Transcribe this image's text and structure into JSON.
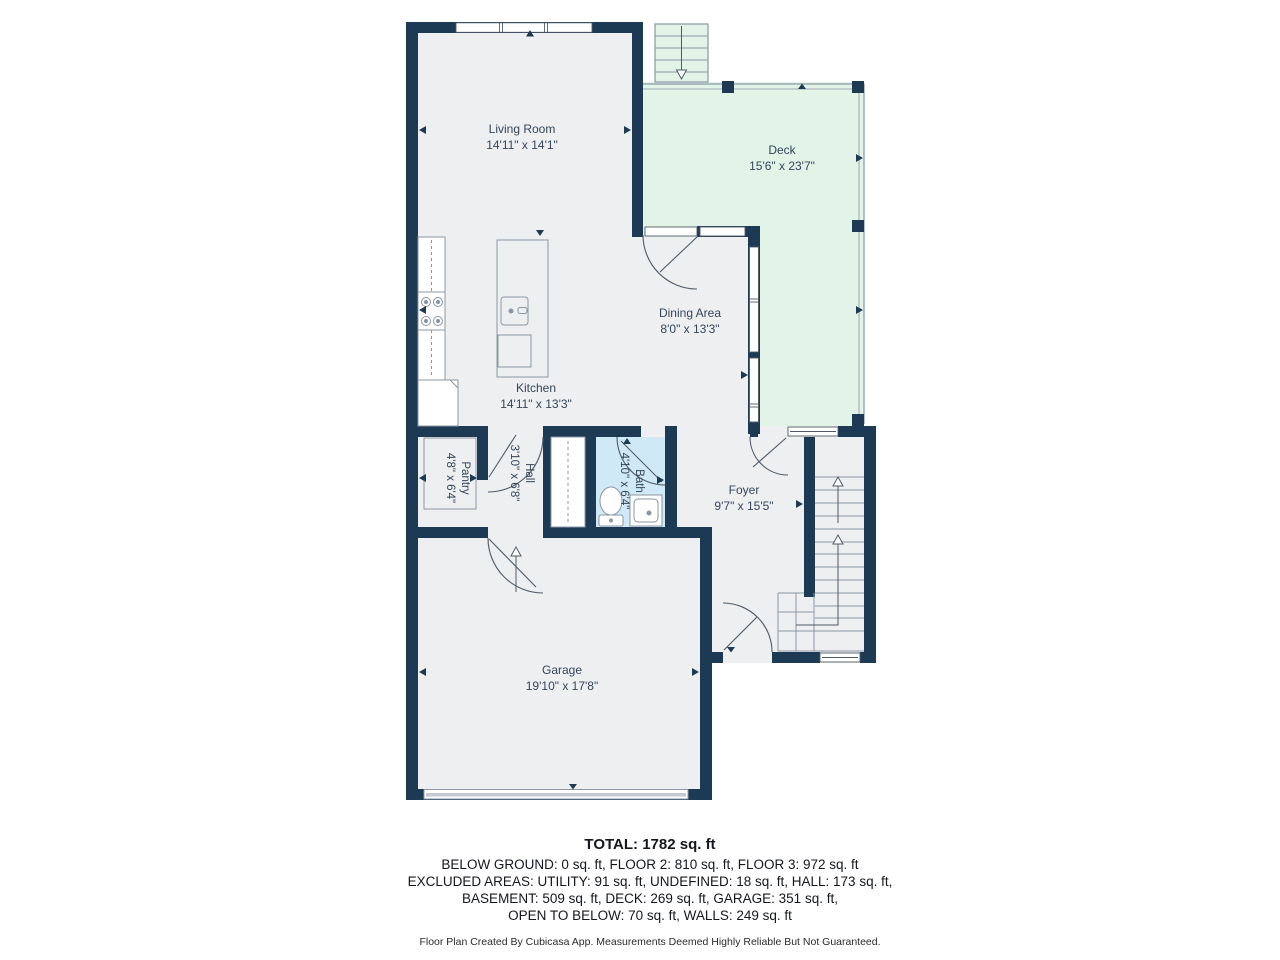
{
  "plan": {
    "rooms": [
      {
        "id": "living_room",
        "name": "Living Room",
        "dimensions": "14'11\" x 14'1\""
      },
      {
        "id": "deck",
        "name": "Deck",
        "dimensions": "15'6\" x 23'7\""
      },
      {
        "id": "dining_area",
        "name": "Dining Area",
        "dimensions": "8'0\" x 13'3\""
      },
      {
        "id": "kitchen",
        "name": "Kitchen",
        "dimensions": "14'11\" x 13'3\""
      },
      {
        "id": "pantry",
        "name": "Pantry",
        "dimensions": "4'8\" x 6'4\""
      },
      {
        "id": "hall",
        "name": "Hall",
        "dimensions": "3'10\" x 6'8\""
      },
      {
        "id": "bath",
        "name": "Bath",
        "dimensions": "4'10\" x 6'4\""
      },
      {
        "id": "foyer",
        "name": "Foyer",
        "dimensions": "9'7\" x 15'5\""
      },
      {
        "id": "garage",
        "name": "Garage",
        "dimensions": "19'10\" x 17'8\""
      }
    ],
    "icons": {
      "wall_marker": "small solid triangle pointing at wall",
      "stair_arrow_up": "↑",
      "stair_arrow_down": "↓"
    }
  },
  "summary": {
    "total": "TOTAL: 1782 sq. ft",
    "lines": [
      "BELOW GROUND: 0 sq. ft, FLOOR 2: 810 sq. ft, FLOOR 3: 972 sq. ft",
      "EXCLUDED AREAS: UTILITY: 91 sq. ft, UNDEFINED: 18 sq. ft, HALL: 173 sq. ft,",
      "BASEMENT: 509 sq. ft, DECK: 269 sq. ft, GARAGE: 351 sq. ft,",
      "OPEN TO BELOW: 70 sq. ft, WALLS: 249 sq. ft"
    ],
    "disclaimer": "Floor Plan Created By Cubicasa App. Measurements Deemed Highly Reliable But Not Guaranteed."
  },
  "colors": {
    "wall": "#1d3a54",
    "floor": "#edeff1",
    "deck": "#e2f3e8",
    "bathfloor": "#cfe9f6",
    "outline": "#8a97a3",
    "door": "#4f5b66",
    "text": "#35465a",
    "sumtext": "#14181d",
    "disc": "#2b2b2b"
  }
}
